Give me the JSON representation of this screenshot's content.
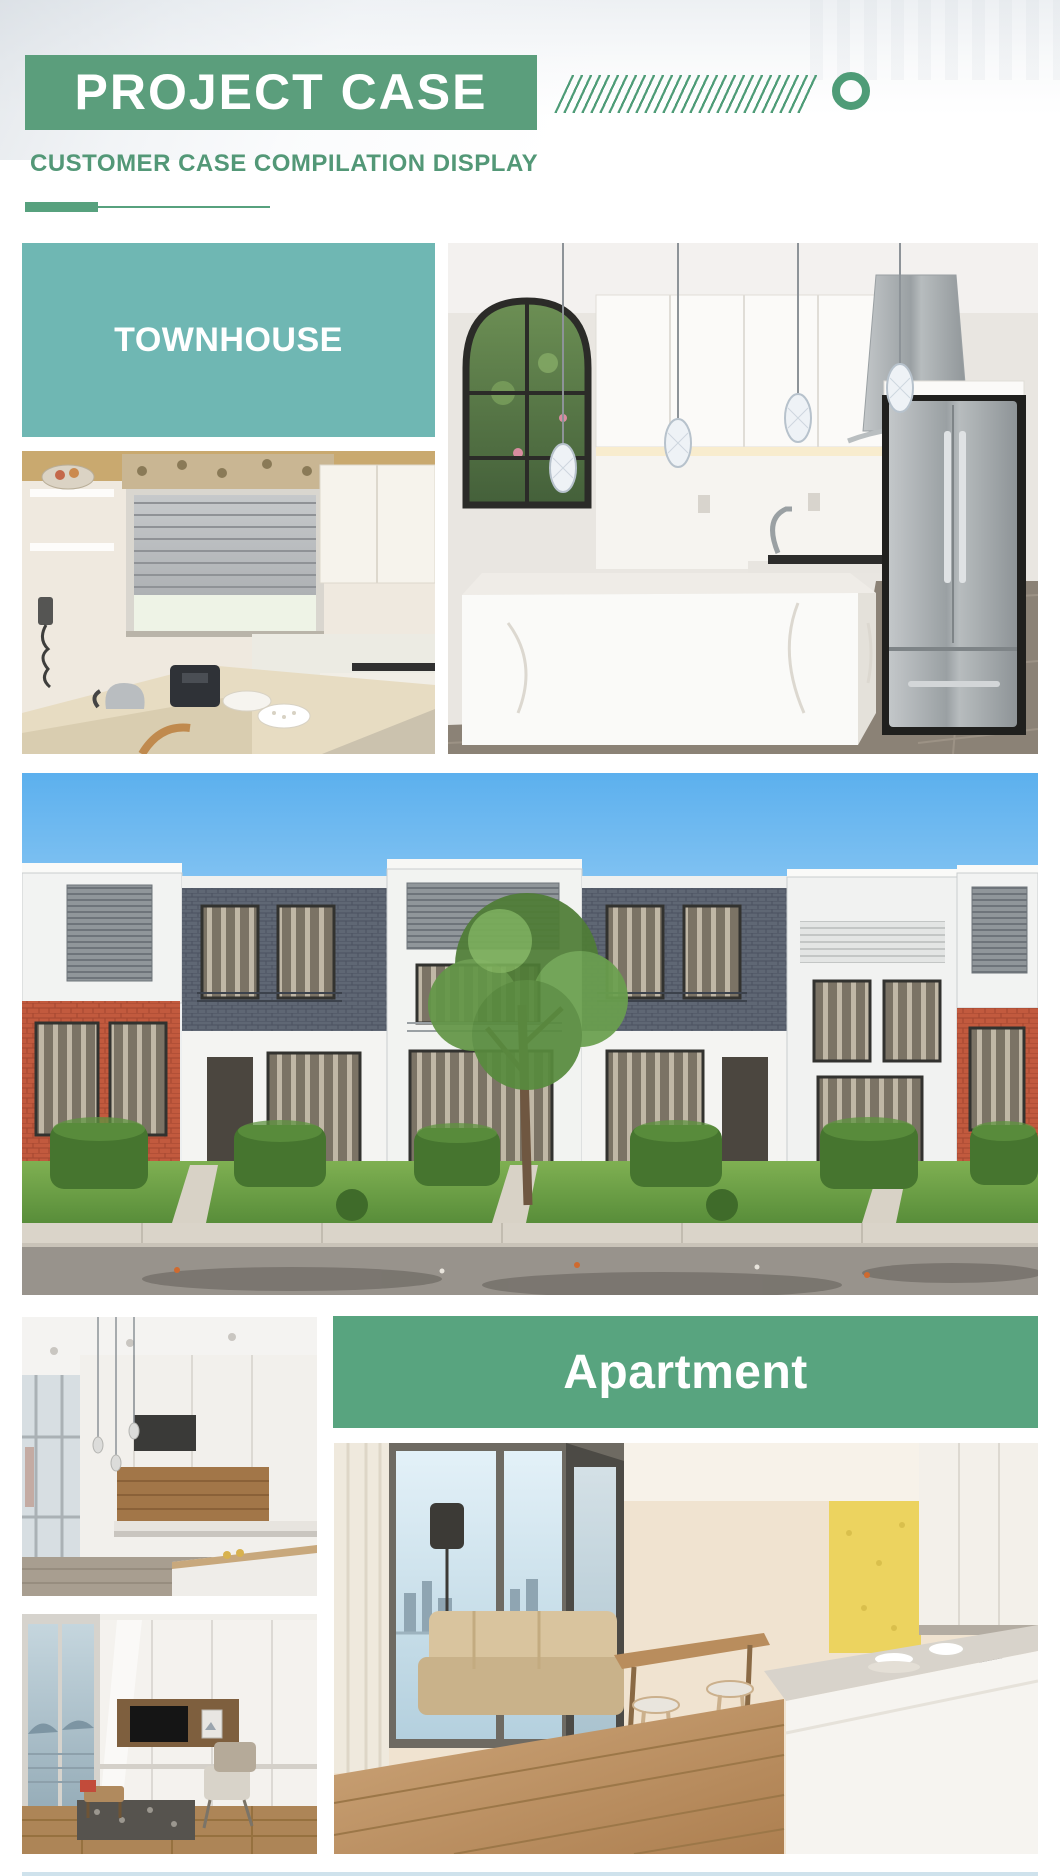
{
  "colors": {
    "brand_green": "#5b9e7c",
    "subtitle_green": "#539877",
    "teal": "#6fb7b3",
    "apartment_green": "#58a47f",
    "hatch_green": "#4e9c77",
    "bottom_strip_blue": "#cfe2ec",
    "header_gray": "#edf0f3"
  },
  "header": {
    "title": "PROJECT CASE",
    "subtitle": "CUSTOMER CASE COMPILATION DISPLAY"
  },
  "sections": {
    "townhouse": {
      "label": "TOWNHOUSE",
      "photos": [
        {
          "name": "townhouse-kitchen-photo-right",
          "alt": "White kitchen with arched window, crystal pendant lights, stainless fridge and marble waterfall island"
        },
        {
          "name": "townhouse-kitchen-photo-left",
          "alt": "Cream kitchen with window blinds, kettle, coffee machine and bowl on bench"
        },
        {
          "name": "townhouse-exterior-photo",
          "alt": "Row of modern two-storey townhouses with brick accents, front lawns, hedges and a street tree"
        }
      ]
    },
    "apartment": {
      "label": "Apartment",
      "photos": [
        {
          "name": "apartment-kitchen-photo-small",
          "alt": "Compact apartment kitchen with timber splashback and pendant lights"
        },
        {
          "name": "apartment-living-kitchen-photo-large",
          "alt": "Open plan apartment living area and island kitchen with balcony city view"
        },
        {
          "name": "apartment-living-photo-small",
          "alt": "Apartment living room with TV joinery wall and balcony"
        }
      ]
    }
  }
}
